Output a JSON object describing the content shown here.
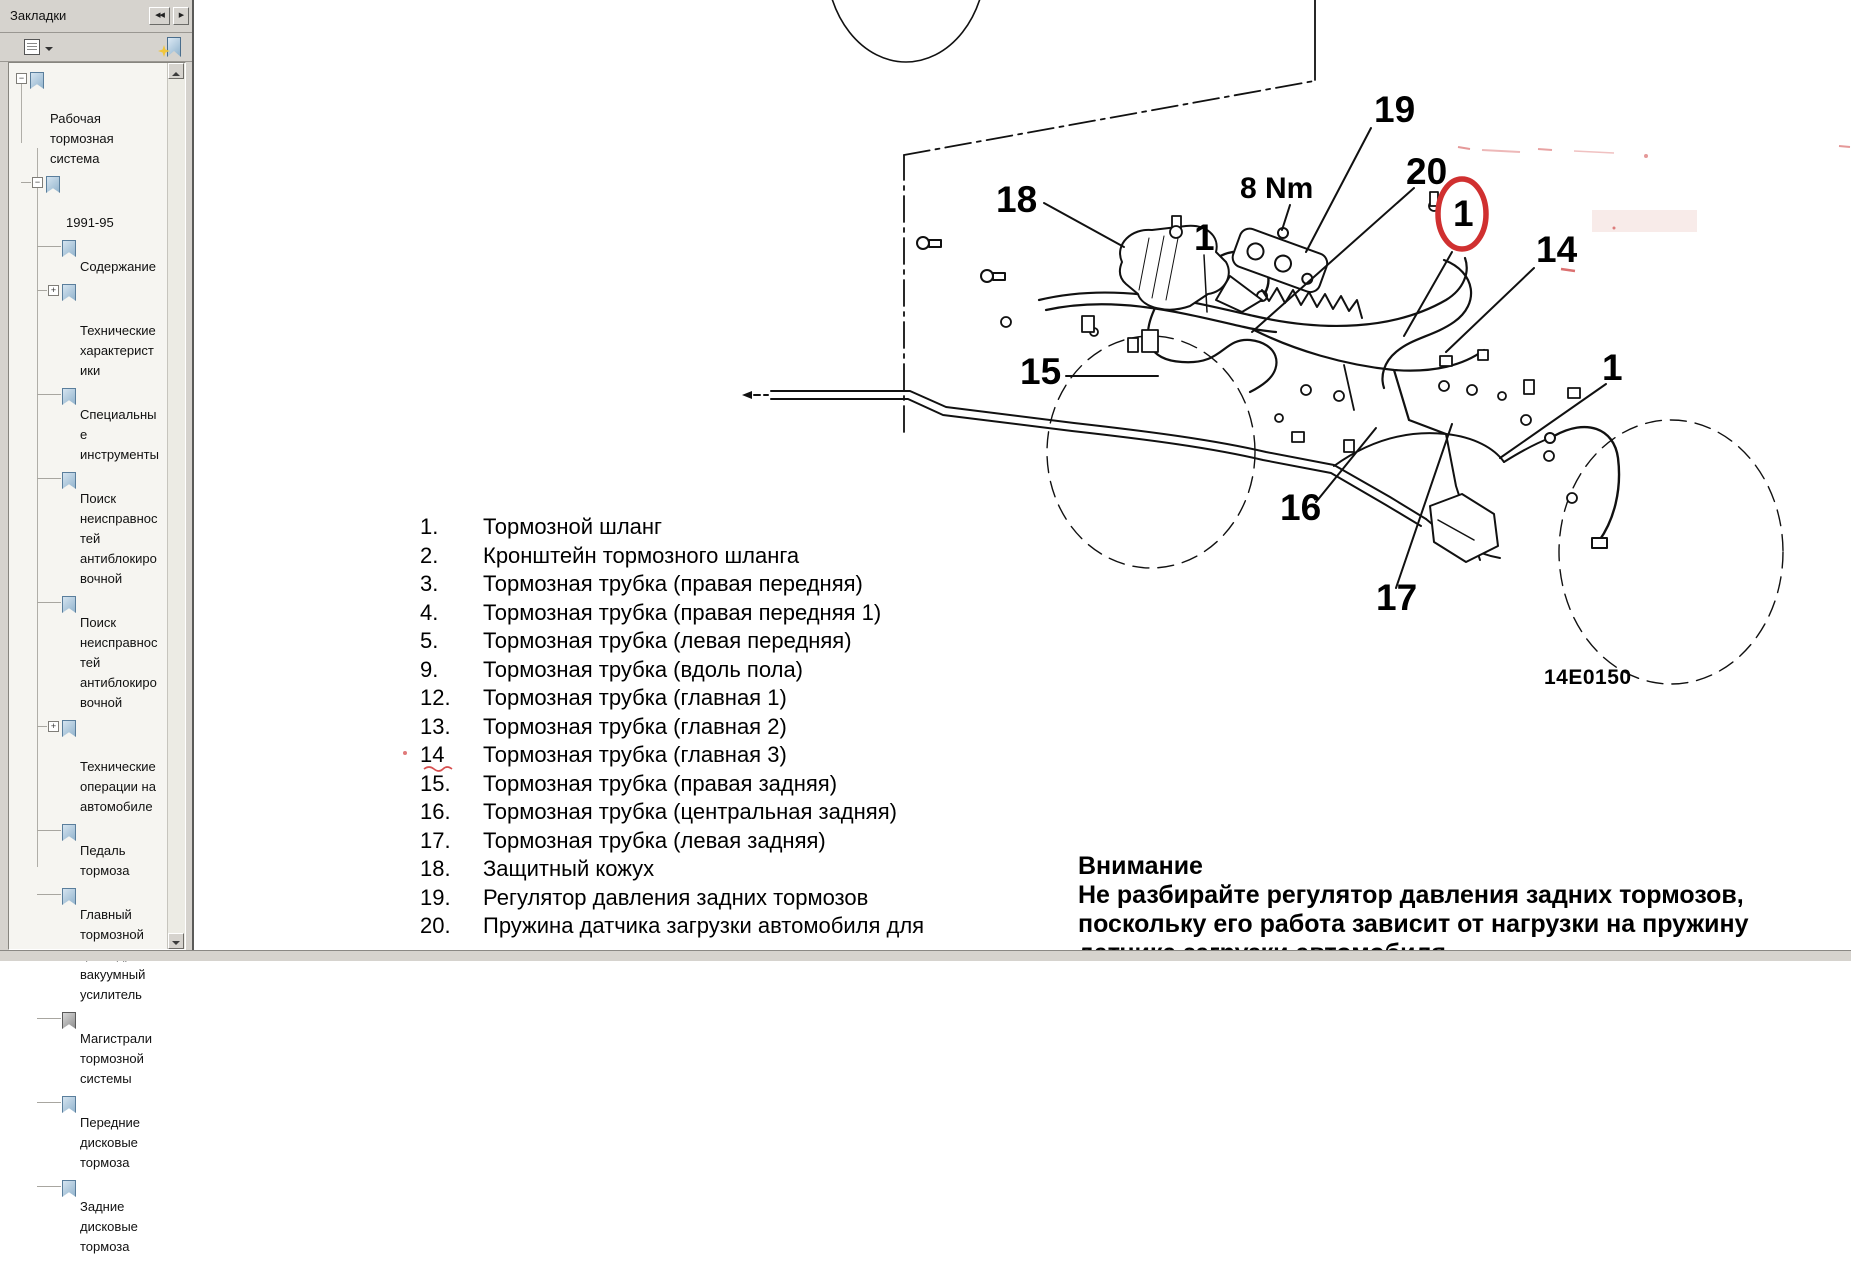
{
  "sidebar": {
    "title": "Закладки",
    "icons": {
      "collapse": "◀◀",
      "forward": "▶"
    },
    "tree": [
      {
        "label": "Рабочая\nтормозная\nсистема"
      },
      {
        "label": "1991-95"
      },
      {
        "label": "Содержание"
      },
      {
        "label": "Технические\nхарактерист\nики"
      },
      {
        "label": "Специальны\nе\nинструменты"
      },
      {
        "label": "Поиск\nнеисправнос\nтей\nантиблокиро\nвочной"
      },
      {
        "label": "Поиск\nнеисправнос\nтей\nантиблокиро\nвочной"
      },
      {
        "label": "Технические\nоперации на\nавтомобиле"
      },
      {
        "label": "Педаль\nтормоза"
      },
      {
        "label": "Главный\nтормозной\nцилиндр и\nвакуумный\nусилитель"
      },
      {
        "label": "Магистрали\nтормозной\nсистемы"
      },
      {
        "label": "Передние\nдисковые\nтормоза"
      },
      {
        "label": "Задние\nдисковые\nтормоза"
      }
    ]
  },
  "parts_list": {
    "items": [
      {
        "num": "1.",
        "text": "Тормозной шланг"
      },
      {
        "num": "2.",
        "text": "Кронштейн тормозного шланга"
      },
      {
        "num": "3.",
        "text": "Тормозная трубка (правая передняя)"
      },
      {
        "num": "4.",
        "text": "Тормозная трубка (правая передняя 1)"
      },
      {
        "num": "5.",
        "text": "Тормозная трубка (левая передняя)"
      },
      {
        "num": "9.",
        "text": "Тормозная трубка (вдоль пола)"
      },
      {
        "num": "12.",
        "text": "Тормозная трубка (главная 1)"
      },
      {
        "num": "13.",
        "text": "Тормозная трубка (главная 2)"
      },
      {
        "num": "14",
        "text": "Тормозная трубка (главная 3)"
      },
      {
        "num": "15.",
        "text": "Тормозная трубка (правая задняя)"
      },
      {
        "num": "16.",
        "text": "Тормозная трубка (центральная задняя)"
      },
      {
        "num": "17.",
        "text": "Тормозная трубка (левая задняя)"
      },
      {
        "num": "18.",
        "text": "Защитный кожух"
      },
      {
        "num": "19.",
        "text": "Регулятор давления задних тормозов"
      },
      {
        "num": "20.",
        "text": "Пружина датчика загрузки автомобиля для"
      }
    ]
  },
  "warning": {
    "title": "Внимание",
    "lines": [
      "Не разбирайте регулятор давления задних тормозов,",
      "поскольку его работа зависит от нагрузки на пружину",
      "датчика загрузки автомобиля"
    ]
  },
  "diagram": {
    "torque_label": "8 Nm",
    "figure_code": "14E0150",
    "callouts": [
      "18",
      "19",
      "20",
      "1",
      "1",
      "14",
      "15",
      "16",
      "17",
      "1"
    ],
    "annotation_color": "#d03030"
  }
}
